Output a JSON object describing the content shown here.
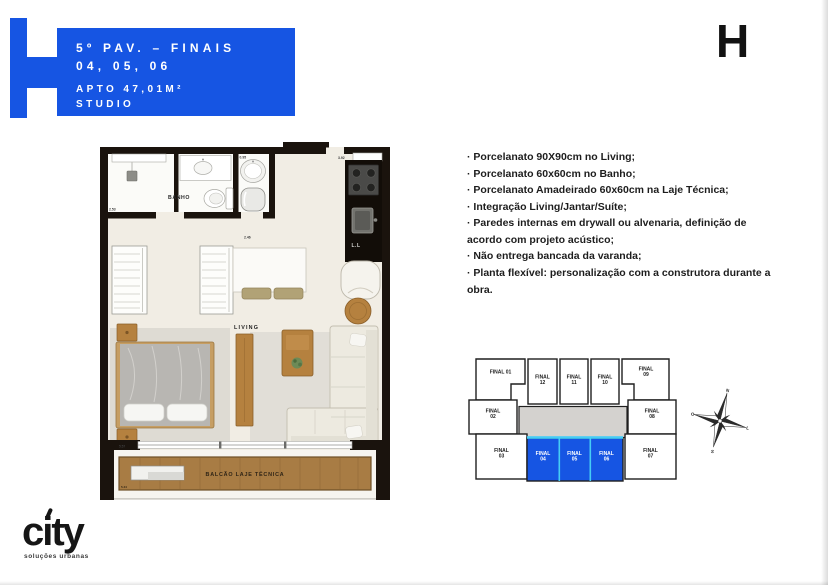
{
  "header": {
    "accent_color": "#1655e3",
    "line1": "5º PAV. – FINAIS",
    "line2": "04, 05, 06",
    "line3": "APTO 47,01M²",
    "line4": "STUDIO"
  },
  "corner_logo": "H",
  "footer_logo": {
    "text": "city",
    "tagline": "soluções urbanas"
  },
  "specs": {
    "items": [
      "· Porcelanato 90X90cm no Living;",
      "· Porcelanato 60x60cm no Banho;",
      "· Porcelanato Amadeirado 60x60cm na Laje Técnica;",
      "· Integração Living/Jantar/Suíte;",
      "· Paredes internas em drywall ou alvenaria, definição de acordo com projeto acústico;",
      "· Não entrega bancada da varanda;",
      "· Planta flexível: personalização com a construtora durante a obra."
    ]
  },
  "floorplan": {
    "room_labels": {
      "bathroom": "BANHO",
      "living": "LIVING",
      "balcony": "BALCÃO LAJE TÉCNICA",
      "laundry": "L.L"
    },
    "dimensions": {
      "bath_left": "2.53",
      "laundry_top": "0.95",
      "kitchen_top": "3.92",
      "laundry_bottom": "2.46",
      "living_bottom": "5.57",
      "balcony_bottom": "5.44"
    }
  },
  "keyplan": {
    "highlight_color": "#1655e3",
    "divider_color": "#45cdf5",
    "corridor_color": "#d4d2cf",
    "units": [
      {
        "id": "final-01",
        "label": "FINAL 01",
        "highlighted": false
      },
      {
        "id": "final-12",
        "label": "FINAL\n12",
        "highlighted": false
      },
      {
        "id": "final-11",
        "label": "FINAL\n11",
        "highlighted": false
      },
      {
        "id": "final-10",
        "label": "FINAL\n10",
        "highlighted": false
      },
      {
        "id": "final-09",
        "label": "FINAL\n09",
        "highlighted": false
      },
      {
        "id": "final-02",
        "label": "FINAL\n02",
        "highlighted": false
      },
      {
        "id": "final-08",
        "label": "FINAL\n08",
        "highlighted": false
      },
      {
        "id": "final-03",
        "label": "FINAL\n03",
        "highlighted": false
      },
      {
        "id": "final-04",
        "label": "FINAL\n04",
        "highlighted": true
      },
      {
        "id": "final-05",
        "label": "FINAL\n05",
        "highlighted": true
      },
      {
        "id": "final-06",
        "label": "FINAL\n06",
        "highlighted": true
      },
      {
        "id": "final-07",
        "label": "FINAL\n07",
        "highlighted": false
      }
    ]
  },
  "compass": {
    "north": "N",
    "east": "L",
    "south": "S",
    "west": "O"
  }
}
